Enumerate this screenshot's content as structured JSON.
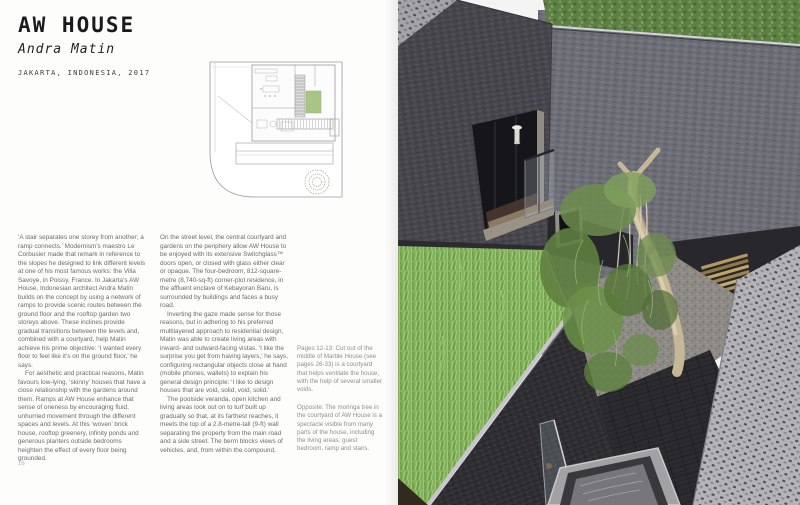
{
  "book": {
    "left_page": {
      "title": "AW HOUSE",
      "architect": "Andra Matin",
      "project_meta": "JAKARTA, INDONESIA, 2017",
      "page_number": "16",
      "body": {
        "col1_p1": "‘A stair separates one storey from another; a ramp connects.’ Modernism’s maestro Le Corbusier made that remark in reference to the slopes he designed to link different levels at one of his most famous works: the Villa Savoye, in Poissy, France. In Jakarta’s AW House, Indonesian architect Andra Matin builds on the concept by using a network of ramps to provide scenic routes between the ground floor and the rooftop garden two storeys above. These inclines provide gradual transitions between the levels and, combined with a courtyard, help Matin achieve his prime objective: ‘I wanted every floor to feel like it’s on the ground floor,’ he says.",
        "col1_p2": "For aesthetic and practical reasons, Matin favours low-lying, ‘skinny’ houses that have a close relationship with the gardens around them. Ramps at AW House enhance that sense of oneness by encouraging fluid, unhurried movement through the different spaces and levels. At this ‘woven’ brick house, rooftop greenery, infinity ponds and generous planters outside bedrooms heighten the effect of every floor being grounded.",
        "col2_p1": "On the street level, the central courtyard and gardens on the periphery allow AW House to be enjoyed with its extensive Switchglass™ doors open, or closed with glass either clear or opaque. The four-bedroom, 812-square-metre (8,740-sq-ft) corner-plot residence, in the affluent enclave of Kebayoran Baru, is surrounded by buildings and faces a busy road.",
        "col2_p2": "Inverting the gaze made sense for those reasons, but in adhering to his preferred multilayered approach to residential design, Matin was able to create living areas with inward- and outward-facing vistas. ‘I like the surprise you get from having layers,’ he says, configuring rectangular objects close at hand (mobile phones, wallets) to explain his general design principle: ‘I like to design houses that are void, solid, void, solid.’",
        "col2_p3": "The poolside veranda, open kitchen and living areas look out on to turf built up gradually so that, at its farthest reaches, it meets the top of a 2.8-metre-tall (9-ft) wall separating the property from the main road and a side street. The berm blocks views of vehicles, and, from within the compound,"
      },
      "captions": {
        "caption1": "Pages 12-13: Cut out of the middle of Marble House (see pages 26-33) is a courtyard that helps ventilate the house, with the help of several smaller voids.",
        "caption2": "Opposite: The moringa tree in the courtyard of AW House is a spectacle visible from many parts of the house, including the living areas, guest bedroom, ramp and stairs."
      }
    },
    "right_page": {
      "type": "full-bleed-photo",
      "subject": "courtyard with moringa tree, woven brick walls, rooftop grass planter"
    }
  },
  "colors": {
    "title_text": "#1a1a1a",
    "body_text": "#6b6b6b",
    "caption_text": "#8f8f8f",
    "plan_green": "#a9c584",
    "ivy_green": "#5e7f45",
    "grass_green": "#83b25c",
    "brick_dark": "#46464c",
    "brick_mid": "#6e6e77"
  }
}
